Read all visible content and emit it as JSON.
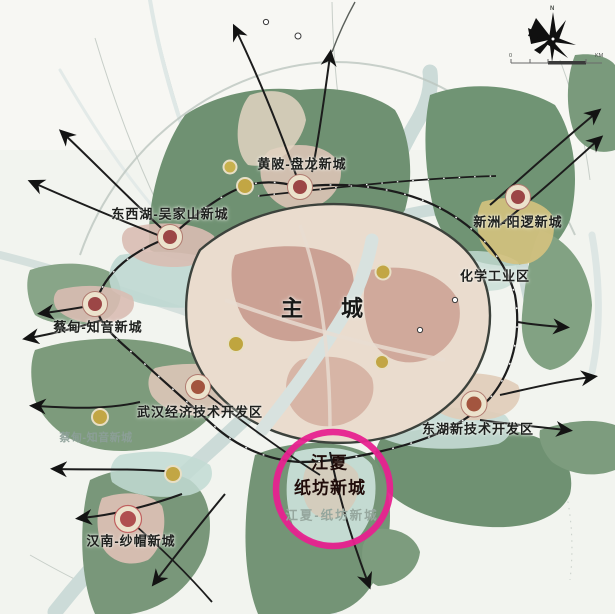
{
  "map_labels": {
    "huangpi_panlong": "黄陂-盘龙新城",
    "dongxihu_wujiashan": "东西湖-吴家山新城",
    "xinzhou_yangluo": "新洲-阳逻新城",
    "chemical_industry_zone": "化学工业区",
    "main_city": "主 城",
    "caidian_zhiyin": "蔡甸-知音新城",
    "caidian_zhiyin_secondary": "蔡甸-知音新城",
    "wuhan_economic_tech_dev_zone": "武汉经济技术开发区",
    "donghu_new_tech_dev_zone": "东湖新技术开发区",
    "hannan_shamao": "汉南-纱帽新城"
  },
  "highlight": {
    "line1": "江夏",
    "line2": "纸坊新城",
    "original_label": "江夏-纸坊新城",
    "ring_color": "#e7218f"
  },
  "compass": {
    "north": "N"
  },
  "scale_bar": {
    "start": "0",
    "unit": "KM"
  },
  "colors": {
    "red_node": "#9c4646",
    "yellow_node": "#c2a644",
    "forest_green": "#6f9172",
    "water": "#ccdbd8",
    "main_city_fill": "#eadcce",
    "road": "#1f1f1f",
    "highlight_text": "#200c0a"
  }
}
